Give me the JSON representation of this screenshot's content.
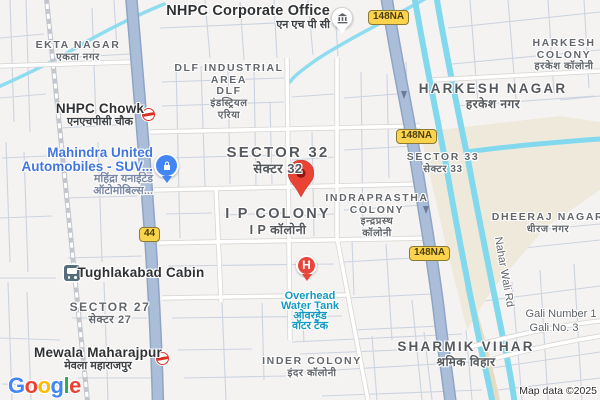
{
  "attribution": "Map data ©2025",
  "logo": {
    "text": "Google",
    "letters": [
      "G",
      "o",
      "o",
      "g",
      "l",
      "e"
    ],
    "letter_colors": [
      "#4285F4",
      "#EA4335",
      "#FBBC04",
      "#4285F4",
      "#34A853",
      "#EA4335"
    ]
  },
  "badges": {
    "nh148": "148NA",
    "nh44": "44"
  },
  "pins": {
    "hospital_letter": "H"
  },
  "colors": {
    "highway_fill": "#abbed9",
    "highway_casing": "#90a4c4",
    "canal": "#82d9ee",
    "open_area": "#efe9dc",
    "destination_pin": "#EA4335",
    "business_pin": "#4285F4",
    "water_label": "#149ac2",
    "badge_bg": "#fcd34d"
  },
  "labels": {
    "nhpc_office": {
      "en": "NHPC Corporate Office",
      "hi": "एन एच पी सी"
    },
    "ekta_nagar": {
      "en": "EKTA NAGAR",
      "hi": "एकता नगर"
    },
    "nhpc_chowk": {
      "en": "NHPC Chowk",
      "hi": "एनएचपीसी चौक"
    },
    "mahindra": {
      "l1": "Mahindra United",
      "l2": "Automobiles -  SUV...",
      "l3": "महिंद्रा यनाईटेड",
      "l4": "ऑटोमोबिल्स..."
    },
    "dlf": {
      "l1": "DLF INDUSTRIAL",
      "l2": "AREA",
      "l3": "DLF",
      "l4": "इंडस्ट्रियल",
      "l5": "एरिया"
    },
    "sector32": {
      "en": "SECTOR 32",
      "hi": "सेक्टर 32"
    },
    "ip_colony": {
      "en": "I P COLONY",
      "hi": "I P कॉलोनी"
    },
    "indraprastha": {
      "l1": "INDRAPRASTHA",
      "l2": "COLONY",
      "l3": "इन्द्रप्रस्थ",
      "l4": "कॉलोनी"
    },
    "sector33": {
      "en": "SECTOR 33",
      "hi": "सेक्टर 33"
    },
    "harkesh_nagar": {
      "en": "HARKESH NAGAR",
      "hi": "हरकेश नगर"
    },
    "harkesh_colony": {
      "l1": "HARKESH",
      "l2": "COLONY",
      "l3": "हरकेश कॉलोनी"
    },
    "dheeraj_nagar": {
      "en": "DHEERAJ NAGAR",
      "hi": "धीरज नगर"
    },
    "nahar_wali_rd": "Nahar Wali Rd",
    "tughlakabad": "Tughlakabad Cabin",
    "sector27": {
      "en": "SECTOR 27",
      "hi": "सेक्टर 27"
    },
    "mewala": {
      "en": "Mewala Maharajpur",
      "hi": "मेवला महाराजपुर"
    },
    "water_tank": {
      "l1": "Overhead",
      "l2": "Water Tank",
      "l3": "ओवरहेड",
      "l4": "वॉटर टैंक"
    },
    "inder_colony": {
      "en": "INDER COLONY",
      "hi": "इंदर कॉलोनी"
    },
    "sharmik_vihar": {
      "en": "SHARMIK VIHAR",
      "hi": "श्रमिक विहार"
    },
    "gali1": "Gali Number 1",
    "gali3": "Gali No. 3"
  }
}
